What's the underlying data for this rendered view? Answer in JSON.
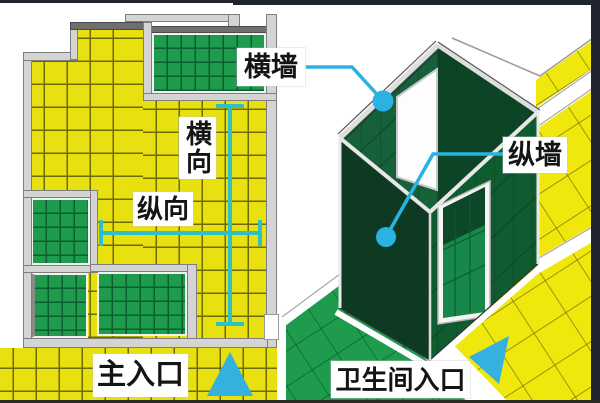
{
  "floor_plan": {
    "direction_vertical_label": "横向",
    "direction_horizontal_label": "纵向",
    "main_entrance_label": "主入口"
  },
  "isometric_view": {
    "transverse_wall_label": "横墙",
    "longitudinal_wall_label": "纵墙",
    "bathroom_entrance_label": "卫生间入口"
  },
  "colors": {
    "floor_tile_yellow": "#e9e00f",
    "room_tile_green": "#1f9b4e",
    "wall_panel_dark_green": "#0f5c30",
    "annotation_cyan": "#29b2e2",
    "measure_teal": "#2dc0c8",
    "wall_gray": "#d4d4d4",
    "frame_dark": "#20242e"
  },
  "icons": {
    "main_entrance_arrow": "triangle-up",
    "bathroom_entrance_arrow": "triangle-left-down",
    "wall_markers": "cyan-circle-leader"
  }
}
